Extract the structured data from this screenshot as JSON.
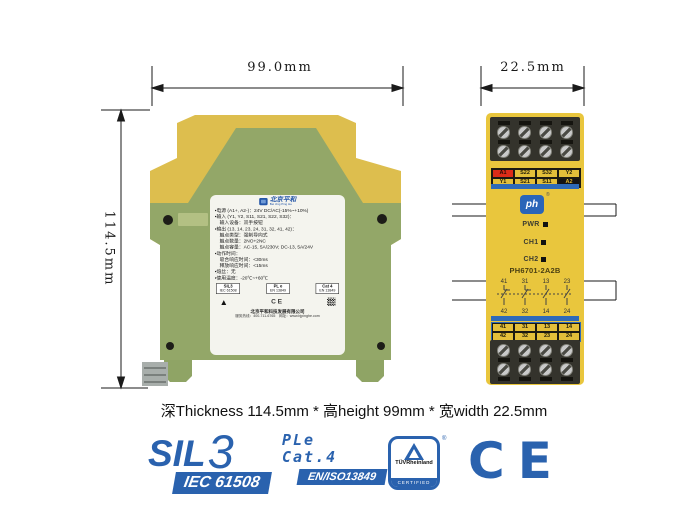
{
  "dimensions": {
    "width": "99.0mm",
    "depth": "22.5mm",
    "height": "114.5mm"
  },
  "caption": "深Thickness 114.5mm * 高height 99mm * 宽width 22.5mm",
  "side_view": {
    "brand_cn": "北京平和",
    "brand_en": "Bei Jing Ping He",
    "spec_lines": [
      "▪电源 (A1+, A2-)：24V DC/AC(-15%~+10%)",
      "▪输入 (Y1, Y2, S11, S21, S22, S32)：",
      "　输入设备：双手按钮",
      "▪输出 (13, 14, 23, 24, 31, 32, 41, 42)：",
      "　触点类型：强制导向式",
      "　触点数量：2NO+2NC",
      "　触点容量：AC-15, 5A/230V; DC-13, 5A/24V",
      "▪动作时间：",
      "　吸合响应时间：<30ms",
      "　释放响应时间：<15ms",
      "▪熔丝：无",
      "▪使用温度：-20℃~+60℃"
    ],
    "cert_boxes": [
      [
        "SIL3",
        "IEC 61508"
      ],
      [
        "PL e",
        "EN 13849"
      ],
      [
        "Cat 4",
        "EN 13849"
      ]
    ],
    "company": "北京平和科技发展有限公司",
    "contact": "服务热线：400-711-6765　网址：www.bjpinghe.com"
  },
  "front_view": {
    "model": "PH6701-2A2B",
    "logo": "ph",
    "logo_reg": "®",
    "leds": [
      "PWR",
      "CH1",
      "CH2"
    ],
    "top_terminals": {
      "row1": [
        "A1",
        "S22",
        "S32",
        "Y2"
      ],
      "row2": [
        "Y1",
        "S21",
        "S11",
        "A2"
      ]
    },
    "contact_top": [
      "41",
      "31",
      "13",
      "23"
    ],
    "contact_bottom": [
      "42",
      "32",
      "14",
      "24"
    ],
    "bottom_terminals": {
      "row1": [
        "41",
        "31",
        "13",
        "14"
      ],
      "row2": [
        "42",
        "32",
        "23",
        "24"
      ]
    }
  },
  "footer_certs": {
    "sil_text": "SIL",
    "sil_level": "3",
    "sil_band": "IEC 61508",
    "pl_line1": "PLe",
    "pl_line2": "Cat.4",
    "pl_band": "EN/ISO13849",
    "tuv_name": "TÜVRheinland",
    "tuv_sub": "CERTIFIED",
    "tuv_reg": "®",
    "ce": "CE",
    "ce_mini": "CE",
    "tuv_mini": "▲"
  },
  "colors": {
    "accent_blue": "#2a62ae",
    "device_yellow": "#e9c63d",
    "device_olive": "#93a768",
    "stripe_blue": "#2e6ab8",
    "terminal_red": "#dc2c18",
    "label_bg": "#f4f4ee"
  }
}
